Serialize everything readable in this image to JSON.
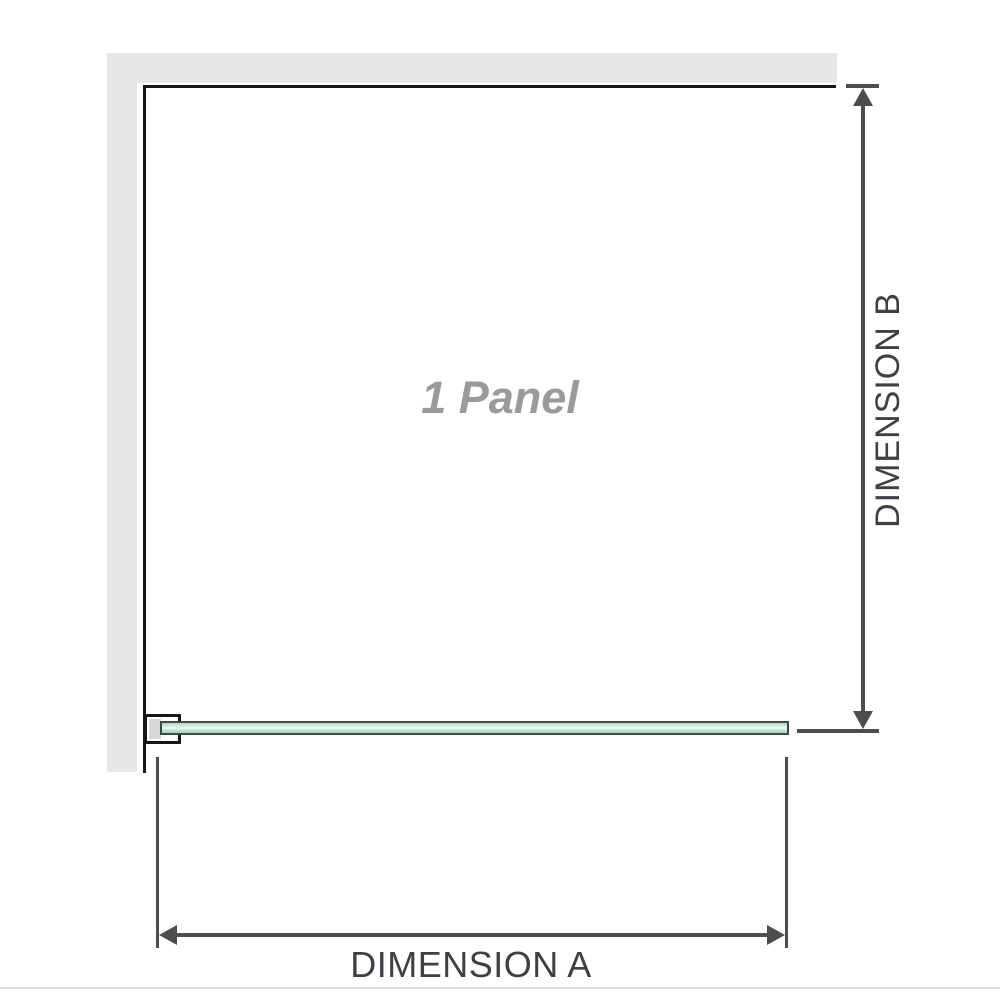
{
  "diagram": {
    "panel_label": "1 Panel",
    "dimension_a_label": "DIMENSION A",
    "dimension_b_label": "DIMENSION B"
  },
  "colors": {
    "wall": "#e7e7e7",
    "panel_outline": "#161616",
    "dimension": "#4d4d4d",
    "label_text": "#3e4045",
    "panel_text": "#9a9a9a",
    "glass_border": "#3f4b42",
    "bracket_inner": "#d8d8d8"
  }
}
